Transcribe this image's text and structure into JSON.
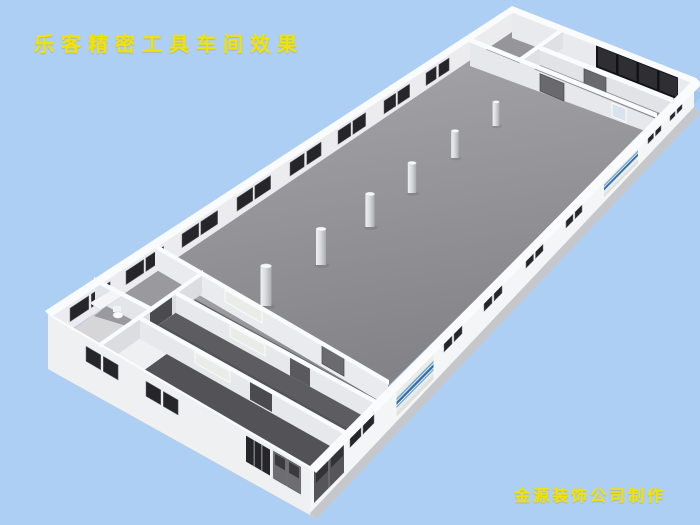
{
  "title": {
    "text": "乐客精密工具车间效果"
  },
  "credit": {
    "text": "金源装饰公司制作"
  },
  "palette": {
    "background": "#aecff4",
    "text_yellow": "#f2e300",
    "wall_exterior": "#f4f5f7",
    "wall_cap": "#fafbfd",
    "wall_inner": "#ececef",
    "floor": "#8f8f93",
    "floor_dark": "#58585c",
    "floor_light": "#d6d6d9",
    "window_dark": "#26262a",
    "door_gray": "#6a6a6e",
    "door_dark": "#4a4a4f",
    "roller_door": "#e9ece8",
    "roller_stripe_light": "#74a9d8",
    "roller_stripe_dark": "#2f6fa9",
    "column_light": "#eef0f2",
    "column_dark": "#aaacb1"
  }
}
